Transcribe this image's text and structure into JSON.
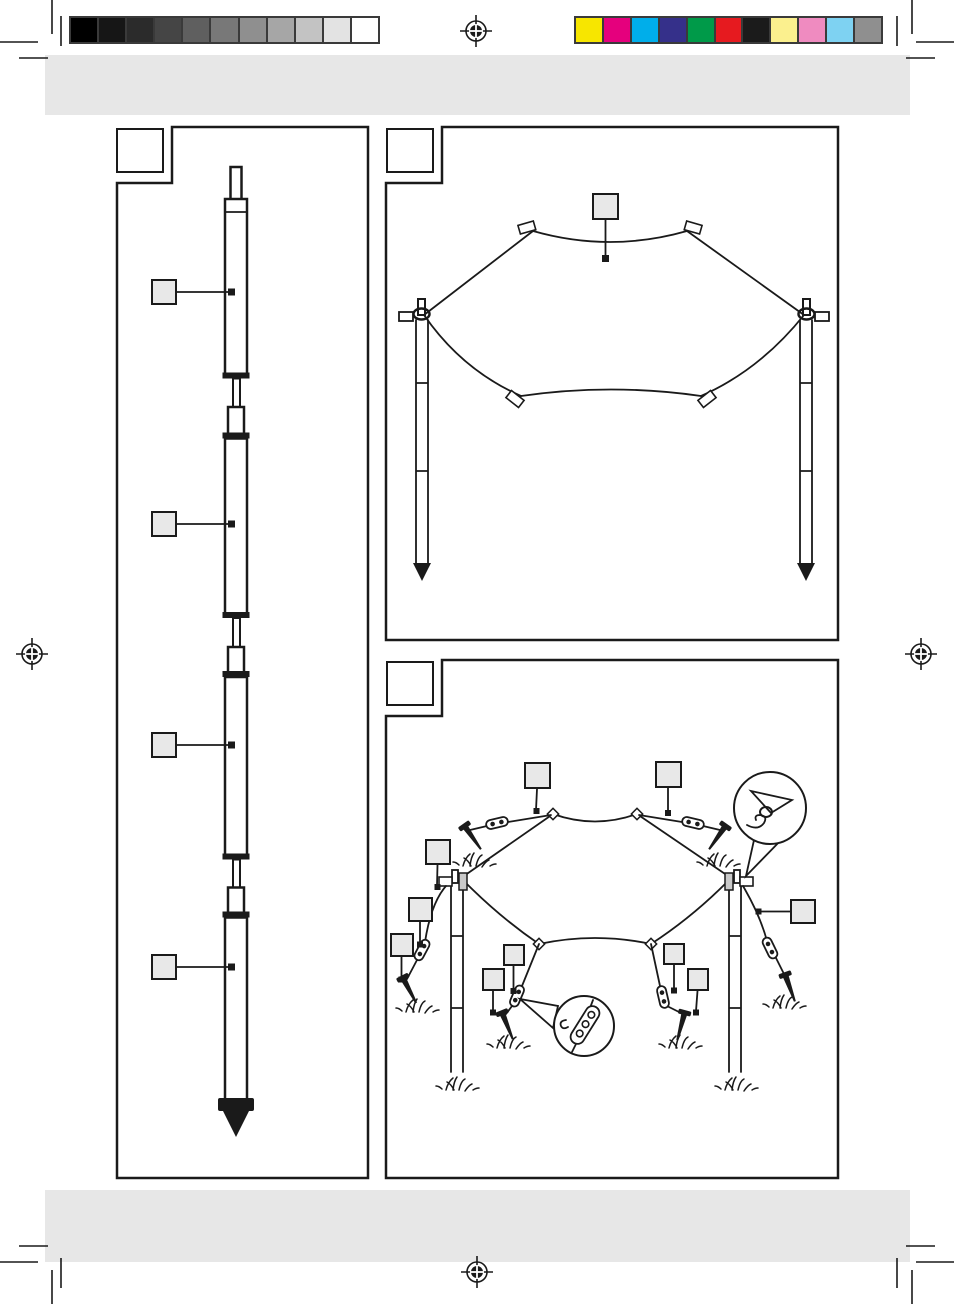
{
  "page": {
    "paper_color": "#ffffff",
    "band_color": "#e7e7e7",
    "line_color": "#1a1a1a",
    "callout_fill": "#e8e8e8"
  },
  "print_calibration": {
    "swatch_border_color": "#3a3a3a",
    "grayscale_swatches": [
      "#000000",
      "#161616",
      "#2b2b2b",
      "#454545",
      "#5f5f5f",
      "#787878",
      "#8f8f8f",
      "#a6a6a6",
      "#c3c3c3",
      "#e3e3e3",
      "#ffffff"
    ],
    "color_swatches": [
      "#f7e600",
      "#e5007d",
      "#00aeea",
      "#35308a",
      "#009a49",
      "#e61a1f",
      "#1b1b1b",
      "#fbf08e",
      "#ef8bc0",
      "#7ed2f2",
      "#8f8f8f"
    ],
    "registration_mark_positions": [
      "top-center",
      "left-middle",
      "right-middle",
      "bottom-center"
    ]
  },
  "panels": {
    "pole_assembly": {
      "label_box_text": "",
      "callout_labels": [
        "",
        "",
        "",
        ""
      ]
    },
    "tarp_overview": {
      "label_box_text": "",
      "callout_labels": [
        ""
      ]
    },
    "tarp_setup": {
      "label_box_text": "",
      "callout_labels": [
        "",
        "",
        "",
        "",
        "",
        "",
        "",
        "",
        "",
        ""
      ]
    }
  }
}
